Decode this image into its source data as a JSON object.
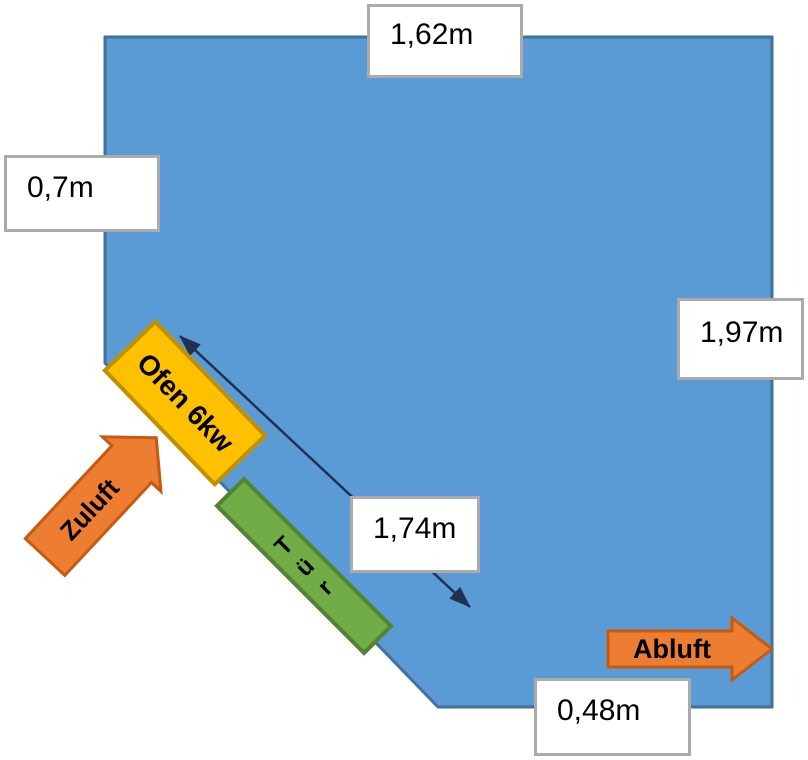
{
  "diagram": {
    "type": "sauna-room-floor-plan",
    "room": {
      "fill": "#5B9BD5",
      "stroke": "#41719C",
      "vertices": [
        [
          105,
          37
        ],
        [
          772,
          37
        ],
        [
          772,
          707
        ],
        [
          438,
          707
        ],
        [
          105,
          363
        ]
      ]
    },
    "labels": {
      "top": {
        "text": "1,62m"
      },
      "left": {
        "text": "0,7m"
      },
      "right": {
        "text": "1,97m"
      },
      "diagonal": {
        "text": "1,74m"
      },
      "bottom": {
        "text": "0,48m"
      }
    },
    "oven": {
      "label": "Ofen 6kw",
      "fill": "#FFC000",
      "border": "#BF9000"
    },
    "door": {
      "word": "Tür",
      "letters": [
        "T",
        "ü",
        "r"
      ],
      "fill": "#70AD47",
      "border": "#548235"
    },
    "airflow": {
      "supply": {
        "label": "Zuluft"
      },
      "exhaust": {
        "label": "Abluft"
      },
      "fill": "#ED7D31",
      "border": "#C55A11"
    },
    "dimension_line": {
      "color": "#1F3050",
      "from": [
        180,
        336
      ],
      "to": [
        470,
        607
      ]
    }
  }
}
